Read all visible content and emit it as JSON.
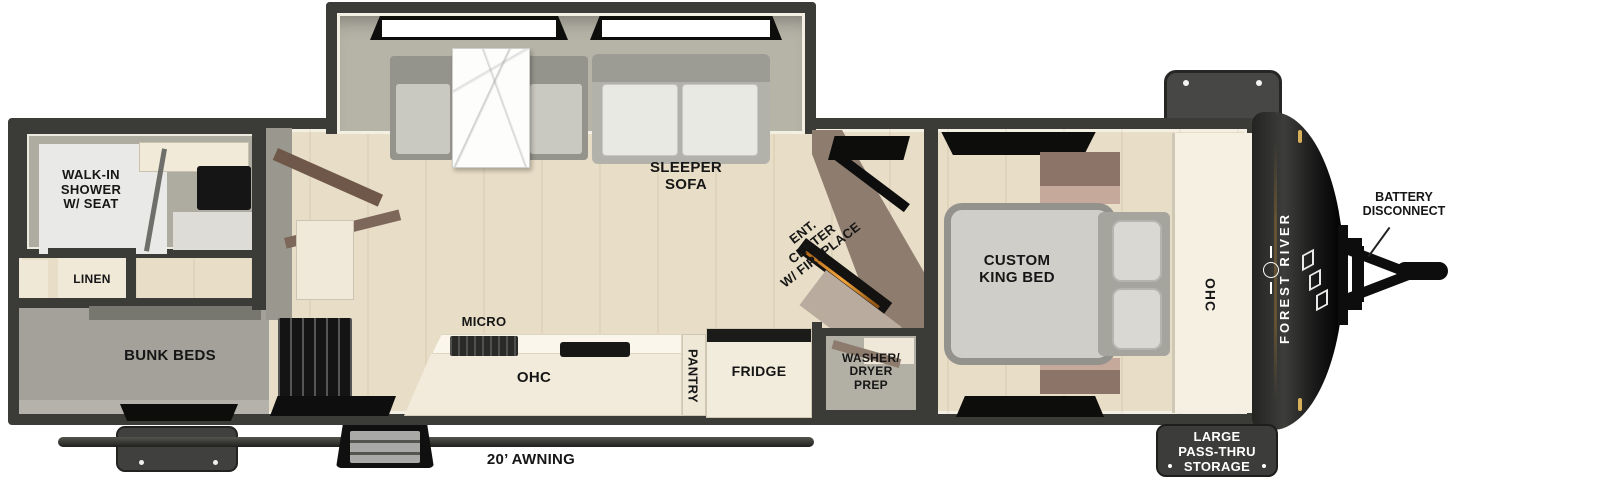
{
  "labels": {
    "walk_in_shower": "WALK-IN\nSHOWER\nW/ SEAT",
    "linen": "LINEN",
    "bunk_beds": "BUNK BEDS",
    "sleeper_sofa": "SLEEPER\nSOFA",
    "micro": "MICRO",
    "ohc_kitchen": "OHC",
    "pantry": "PANTRY",
    "fridge": "FRIDGE",
    "ent_center": "ENT.\nCENTER\nW/ FIREPLACE",
    "washer_dryer": "WASHER/\nDRYER\nPREP",
    "custom_king_bed": "CUSTOM\nKING BED",
    "ohc_bedroom": "OHC",
    "brand": "FOREST RIVER",
    "battery_disconnect": "BATTERY\nDISCONNECT",
    "pass_thru_storage": "LARGE\nPASS-THRU\nSTORAGE",
    "awning": "20’ AWNING"
  },
  "icons": {
    "brand_logo": "forest-river-emblem",
    "brand_stripes": "triple-stripe-logo"
  },
  "colors": {
    "wall": "#3b3b38",
    "floor": "#e8ddc6",
    "slide_interior": "#b6b4a7",
    "bunk_gray": "#a3a199",
    "counter_cream": "#f2ebdb",
    "cabinet_brown": "#8c7568",
    "bed_gray": "#d0cec9",
    "front_cap_black": "#1a1a19",
    "amber_marker": "#d8b05a",
    "storage_box": "#3c3c3a",
    "label_black": "#161616",
    "storage_text_white": "#ffffff",
    "fireplace_glow": "#f4a63d"
  }
}
